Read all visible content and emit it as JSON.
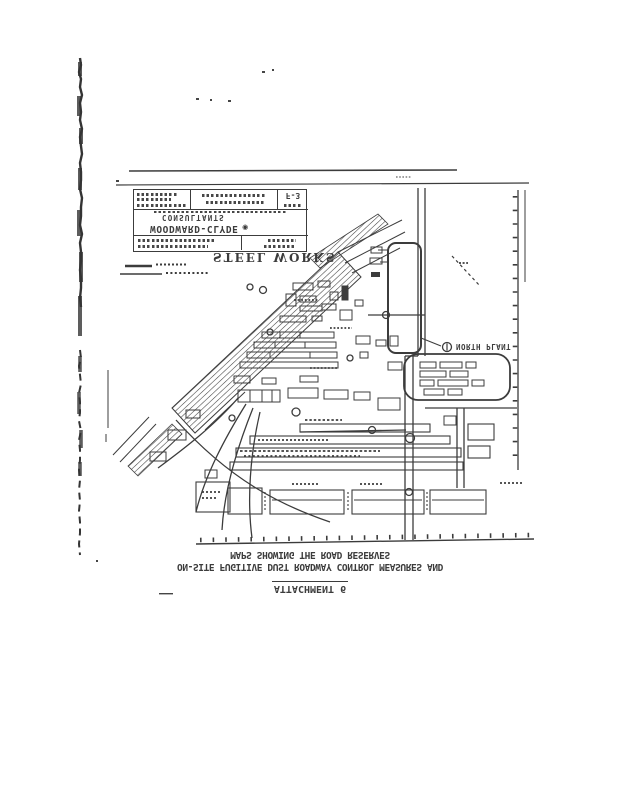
{
  "page": {
    "paper_color": "#ffffff",
    "ink_color": "#3c3c3c"
  },
  "map": {
    "steel_works_label": "STEEL WORKS",
    "north_plant_label": "NORTH PLANT"
  },
  "title_block": {
    "company_name": "WOODWARD-CLYDE",
    "company_type": "CONSULTANTS",
    "logo_glyph": "◉",
    "sheet_number": "F-3"
  },
  "caption": {
    "attachment_line": "ATTACHMENT 6",
    "title_line": "ON-SITE FUGITIVE DUST ROADWAY CONTROL MEASURES AND",
    "subtitle_line": "MAPS SHOWING THE ROAD RESERVES"
  }
}
